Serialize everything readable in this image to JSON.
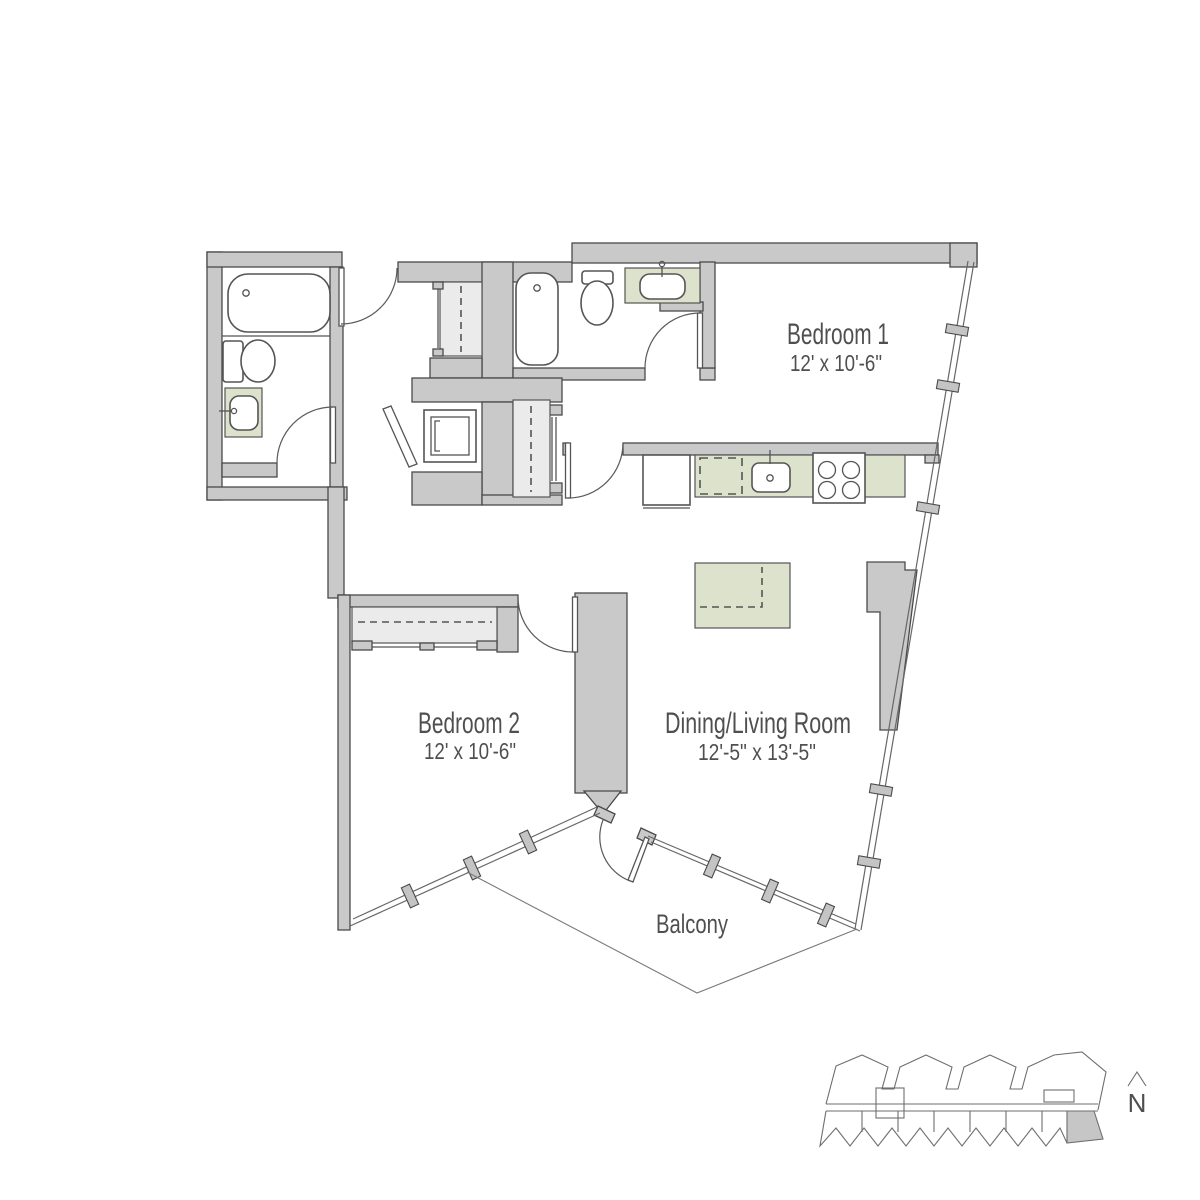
{
  "rooms": {
    "bedroom1": {
      "name": "Bedroom 1",
      "dims": "12' x 10'-6\""
    },
    "bedroom2": {
      "name": "Bedroom 2",
      "dims": "12' x 10'-6\""
    },
    "living": {
      "name": "Dining/Living Room",
      "dims": "12'-5\" x 13'-5\""
    },
    "balcony": {
      "name": "Balcony"
    }
  },
  "compass": {
    "label": "N"
  },
  "colors": {
    "wall": "#c9c9c9",
    "wall_stroke": "#4a4a4a",
    "green": "#dce2cc",
    "closet": "#ebebeb",
    "line": "#5a5a5a",
    "text": "#4f4f4f",
    "balcony_line": "#7a7a7a",
    "keyplan_line": "#6e6e6e",
    "keyplan_highlight": "#c6c6c6"
  }
}
